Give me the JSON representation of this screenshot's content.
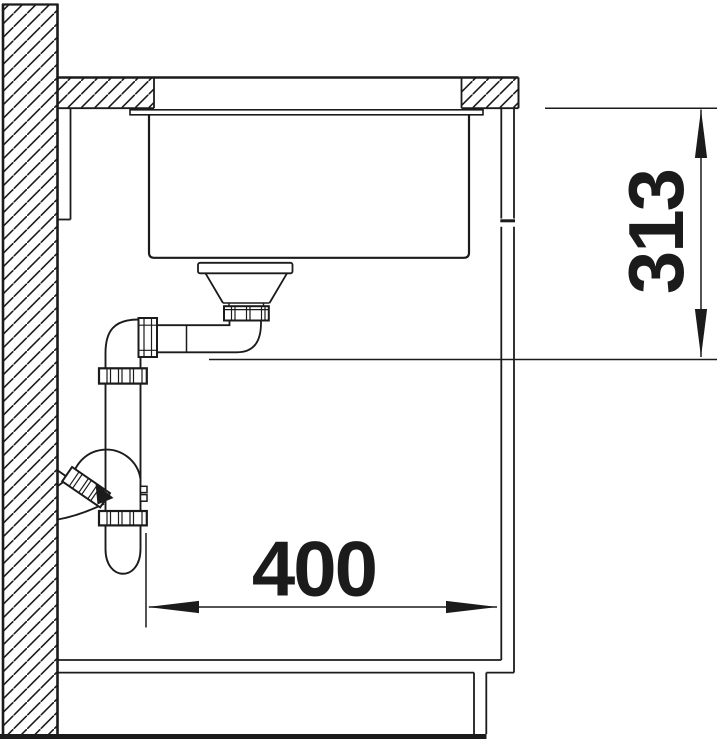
{
  "page": {
    "background": "#ffffff",
    "line_color": "#1b1b1b"
  },
  "diagram": {
    "type": "technical-drawing-section",
    "subject": "undermount-sink-installation-side-section",
    "components": [
      "wall",
      "worktop",
      "worktop-cutout",
      "sink-flange",
      "sink-bowl",
      "strainer-drain",
      "drain-tailpipe",
      "drain-elbow",
      "union-nut",
      "vertical-drain-pipe",
      "siphon-trap-bend",
      "wall-outlet-union",
      "cabinet-side-panel",
      "cabinet-bottom-shelf",
      "plinth",
      "floor",
      "wall-ledger-strip"
    ],
    "dimensions": {
      "worktop_to_drain_height": {
        "label": "313",
        "orientation": "vertical"
      },
      "min_cabinet_width": {
        "label": "400",
        "orientation": "horizontal"
      }
    }
  }
}
